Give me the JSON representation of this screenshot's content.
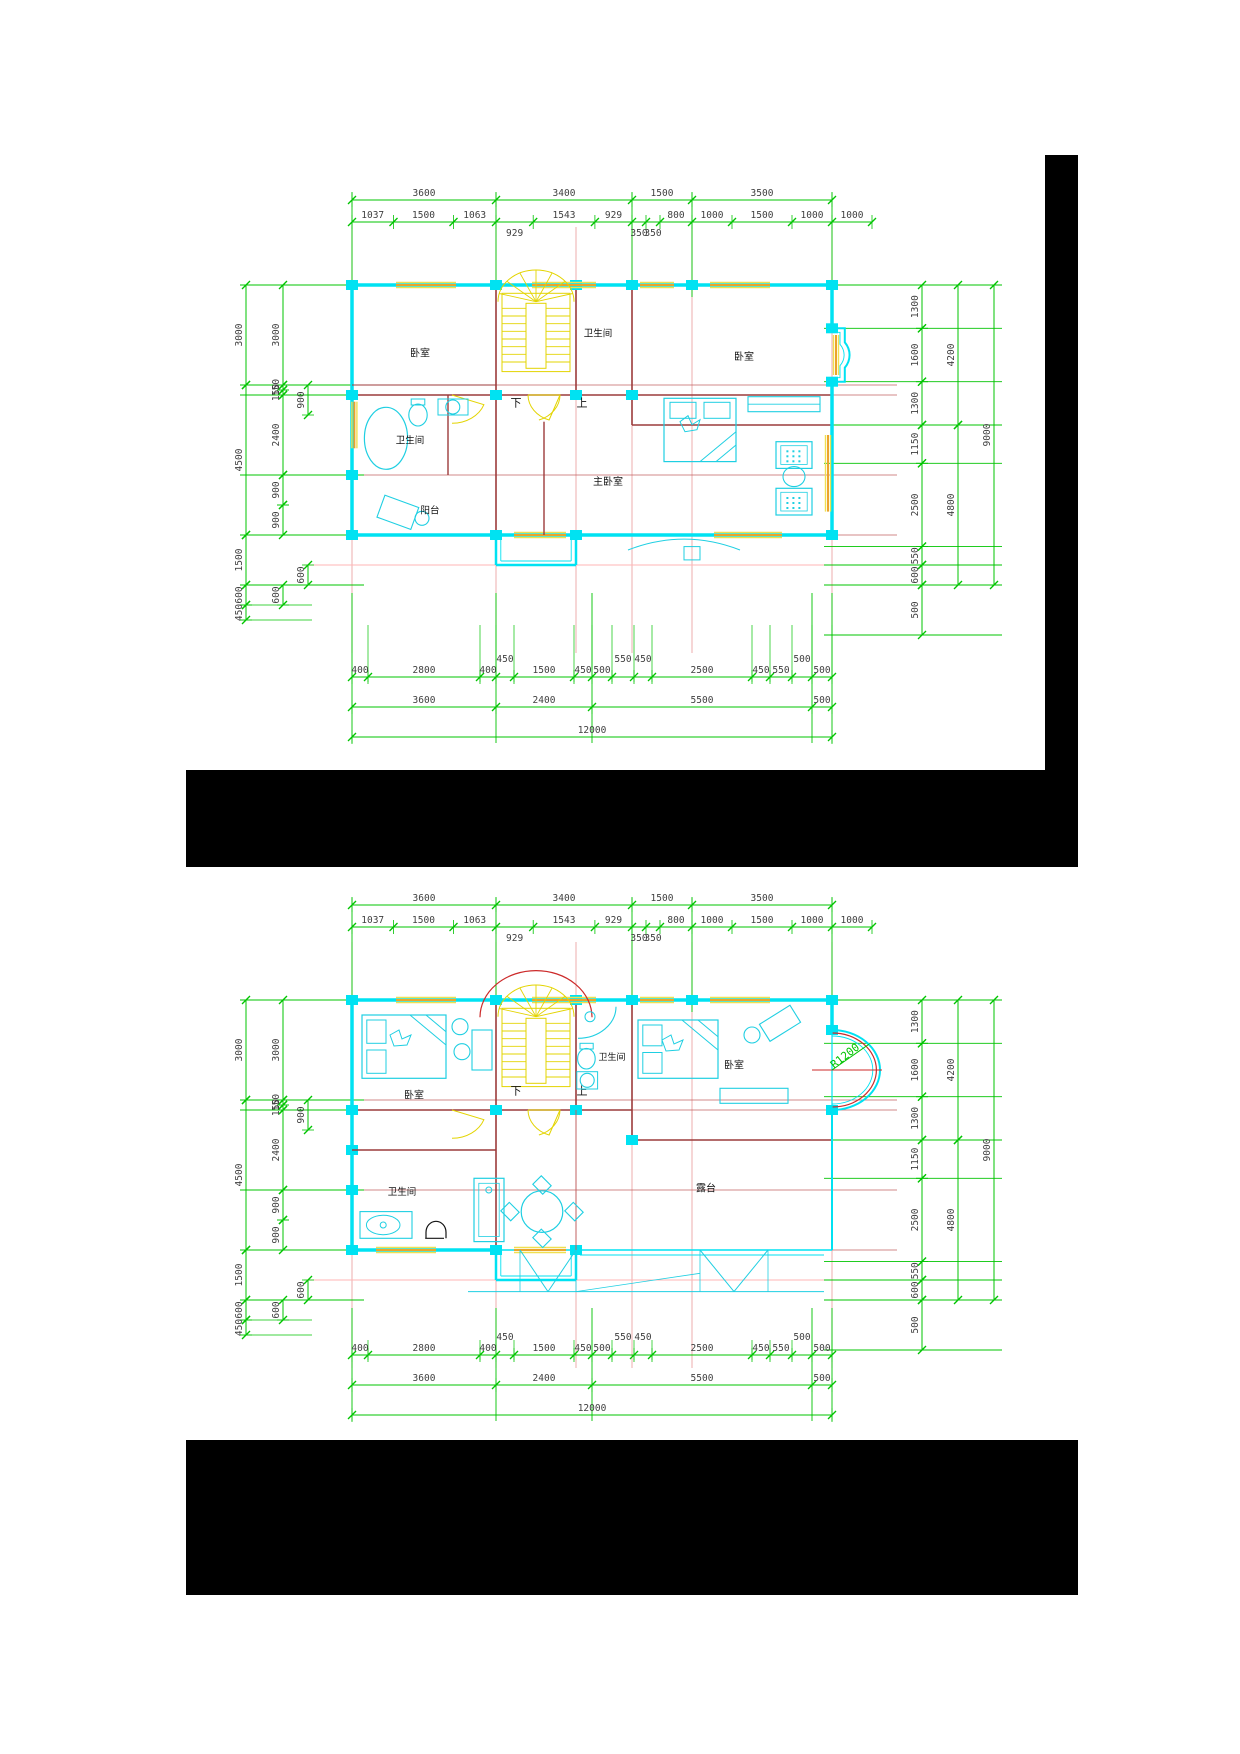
{
  "document": {
    "background": "#ffffff",
    "type": "cad-floor-plan-sheet"
  },
  "colors": {
    "dim_line": "#00c400",
    "dim_text": "#3f3f3f",
    "label_text": "#141414",
    "wall": "#00e2f2",
    "furniture": "#1fcfe2",
    "grid_dark": "#9c3b3b",
    "grid_mid": "#c06060",
    "grid_light": "#e89a9a",
    "pink_line": "#ffb6b6",
    "stair": "#e3d400",
    "window_outer": "#f0e050",
    "window_core": "#eba32c",
    "radius_arc": "#cc2a2a",
    "redaction": "#000000"
  },
  "plans": [
    {
      "id": "floor-plan-upper",
      "room_labels": {
        "bedroom_left": "卧室",
        "bathroom_top": "卫生间",
        "bedroom_right": "卧室",
        "bathroom_left": "卫生间",
        "master_bedroom": "主卧室",
        "balcony": "阳台"
      },
      "stair_labels": {
        "down": "下",
        "up": "上"
      },
      "dims": {
        "top_row1": [
          "3600",
          "3400",
          "1500",
          "3500"
        ],
        "top_row2": [
          "1037",
          "1500",
          "1063",
          "929",
          "1543",
          "929",
          "350",
          "350",
          "800",
          "1000",
          "1500",
          "1000",
          "1000"
        ],
        "left_outer": [
          "3000",
          "4500",
          "1500",
          "600",
          "450"
        ],
        "left_inner": [
          "3000",
          "150",
          "150",
          "2400",
          "900",
          "900",
          "600"
        ],
        "left_mid": [
          "900",
          "600"
        ],
        "right_inner": [
          "1300",
          "1600",
          "1300",
          "1150",
          "2500",
          "550",
          "600",
          "500"
        ],
        "right_mid": [
          "4200",
          "4800"
        ],
        "right_outer": [
          "9000"
        ],
        "bottom_detail": [
          "400",
          "2800",
          "400",
          "450",
          "1500",
          "450",
          "500",
          "550",
          "450",
          "2500",
          "450",
          "550",
          "500",
          "500"
        ],
        "bottom_mid": [
          "3600",
          "2400",
          "5500",
          "500"
        ],
        "bottom_total": [
          "12000"
        ]
      }
    },
    {
      "id": "floor-plan-lower",
      "room_labels": {
        "bedroom_left": "卧室",
        "bathroom_top": "卫生间",
        "bedroom_right": "卧室",
        "bathroom_bottom": "卫生间",
        "terrace": "露台"
      },
      "stair_labels": {
        "down": "下",
        "up": "上"
      },
      "annotations": {
        "radius": "R1200"
      },
      "dims": {
        "top_row1": [
          "3600",
          "3400",
          "1500",
          "3500"
        ],
        "top_row2": [
          "1037",
          "1500",
          "1063",
          "929",
          "1543",
          "929",
          "350",
          "350",
          "800",
          "1000",
          "1500",
          "1000",
          "1000"
        ],
        "left_outer": [
          "3000",
          "4500",
          "1500",
          "600",
          "450"
        ],
        "left_inner": [
          "3000",
          "150",
          "150",
          "2400",
          "900",
          "900",
          "600"
        ],
        "left_mid": [
          "900",
          "600"
        ],
        "right_inner": [
          "1300",
          "1600",
          "1300",
          "1150",
          "2500",
          "550",
          "600",
          "500"
        ],
        "right_mid": [
          "4200",
          "4800"
        ],
        "right_outer": [
          "9000"
        ],
        "bottom_detail": [
          "400",
          "2800",
          "400",
          "450",
          "1500",
          "450",
          "500",
          "550",
          "450",
          "2500",
          "450",
          "550",
          "500",
          "500"
        ],
        "bottom_mid": [
          "3600",
          "2400",
          "5500",
          "500"
        ],
        "bottom_total": [
          "12000"
        ]
      }
    }
  ]
}
